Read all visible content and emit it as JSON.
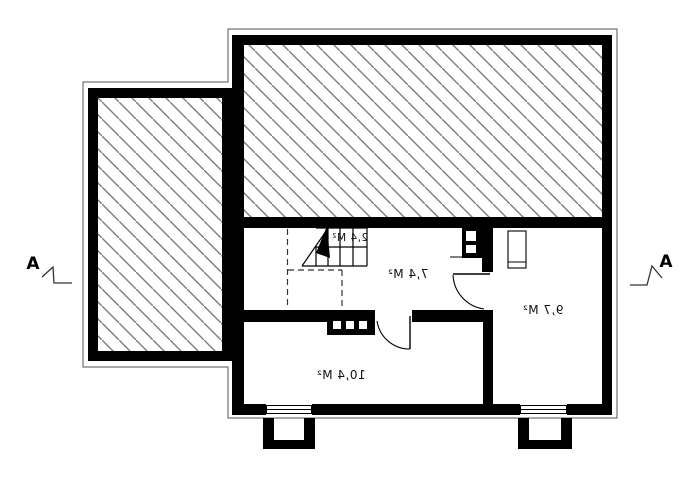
{
  "drawing": {
    "kind": "floor-plan",
    "text_mirrored": true,
    "room_labels": {
      "stairs": "2,4 M²",
      "hall": "7,4 M²",
      "room_right": "9,7 M²",
      "room_large": "10,4 M²"
    },
    "section_markers": {
      "left": "A",
      "right": "A"
    },
    "colors": {
      "wall": "#000000",
      "background": "#ffffff",
      "hatch_line": "#7d7d7d",
      "contour_line": "#555555",
      "text": "#111111"
    }
  }
}
